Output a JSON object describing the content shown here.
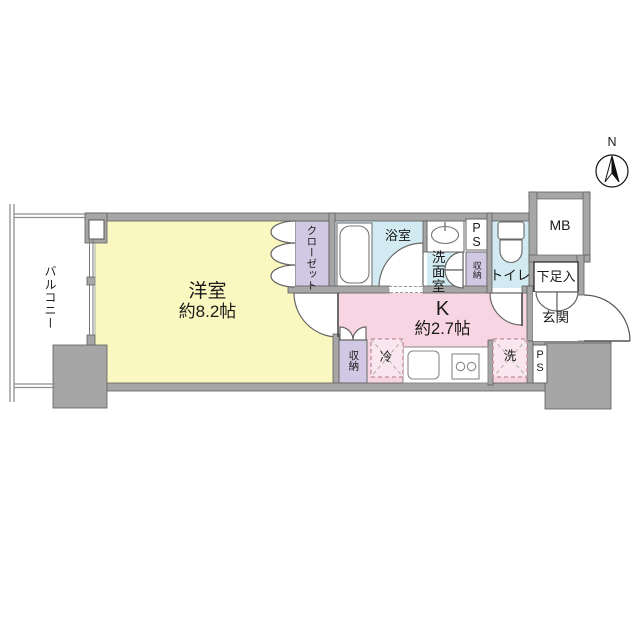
{
  "compass": {
    "north_label": "N"
  },
  "rooms": {
    "balcony": {
      "label": "バルコニー"
    },
    "western_room": {
      "label": "洋室",
      "size": "約8.2帖"
    },
    "closet": {
      "label": "クローゼット"
    },
    "bathroom": {
      "label": "浴室"
    },
    "washroom": {
      "label": "洗面室"
    },
    "kitchen": {
      "label": "K",
      "size": "約2.7帖"
    },
    "toilet": {
      "label": "トイレ"
    },
    "entrance": {
      "label": "玄関"
    },
    "shoe_cabinet": {
      "label": "下足入"
    },
    "meter_box": {
      "label": "MB"
    },
    "pipe_space_top": {
      "label": "P\nS"
    },
    "pipe_space_bottom": {
      "label": "P\nS"
    },
    "storage_washroom": {
      "label": "収納"
    },
    "storage_kitchen": {
      "label": "収納"
    },
    "refrigerator_space": {
      "label": "冷"
    },
    "washer_space": {
      "label": "洗"
    }
  },
  "colors": {
    "room_yellow": "#FBF7C0",
    "kitchen_pink": "#F8D5E2",
    "wet_area_blue": "#D2EAF2",
    "storage_purple": "#D1C8E3",
    "wall_gray": "#A6A6A6"
  }
}
